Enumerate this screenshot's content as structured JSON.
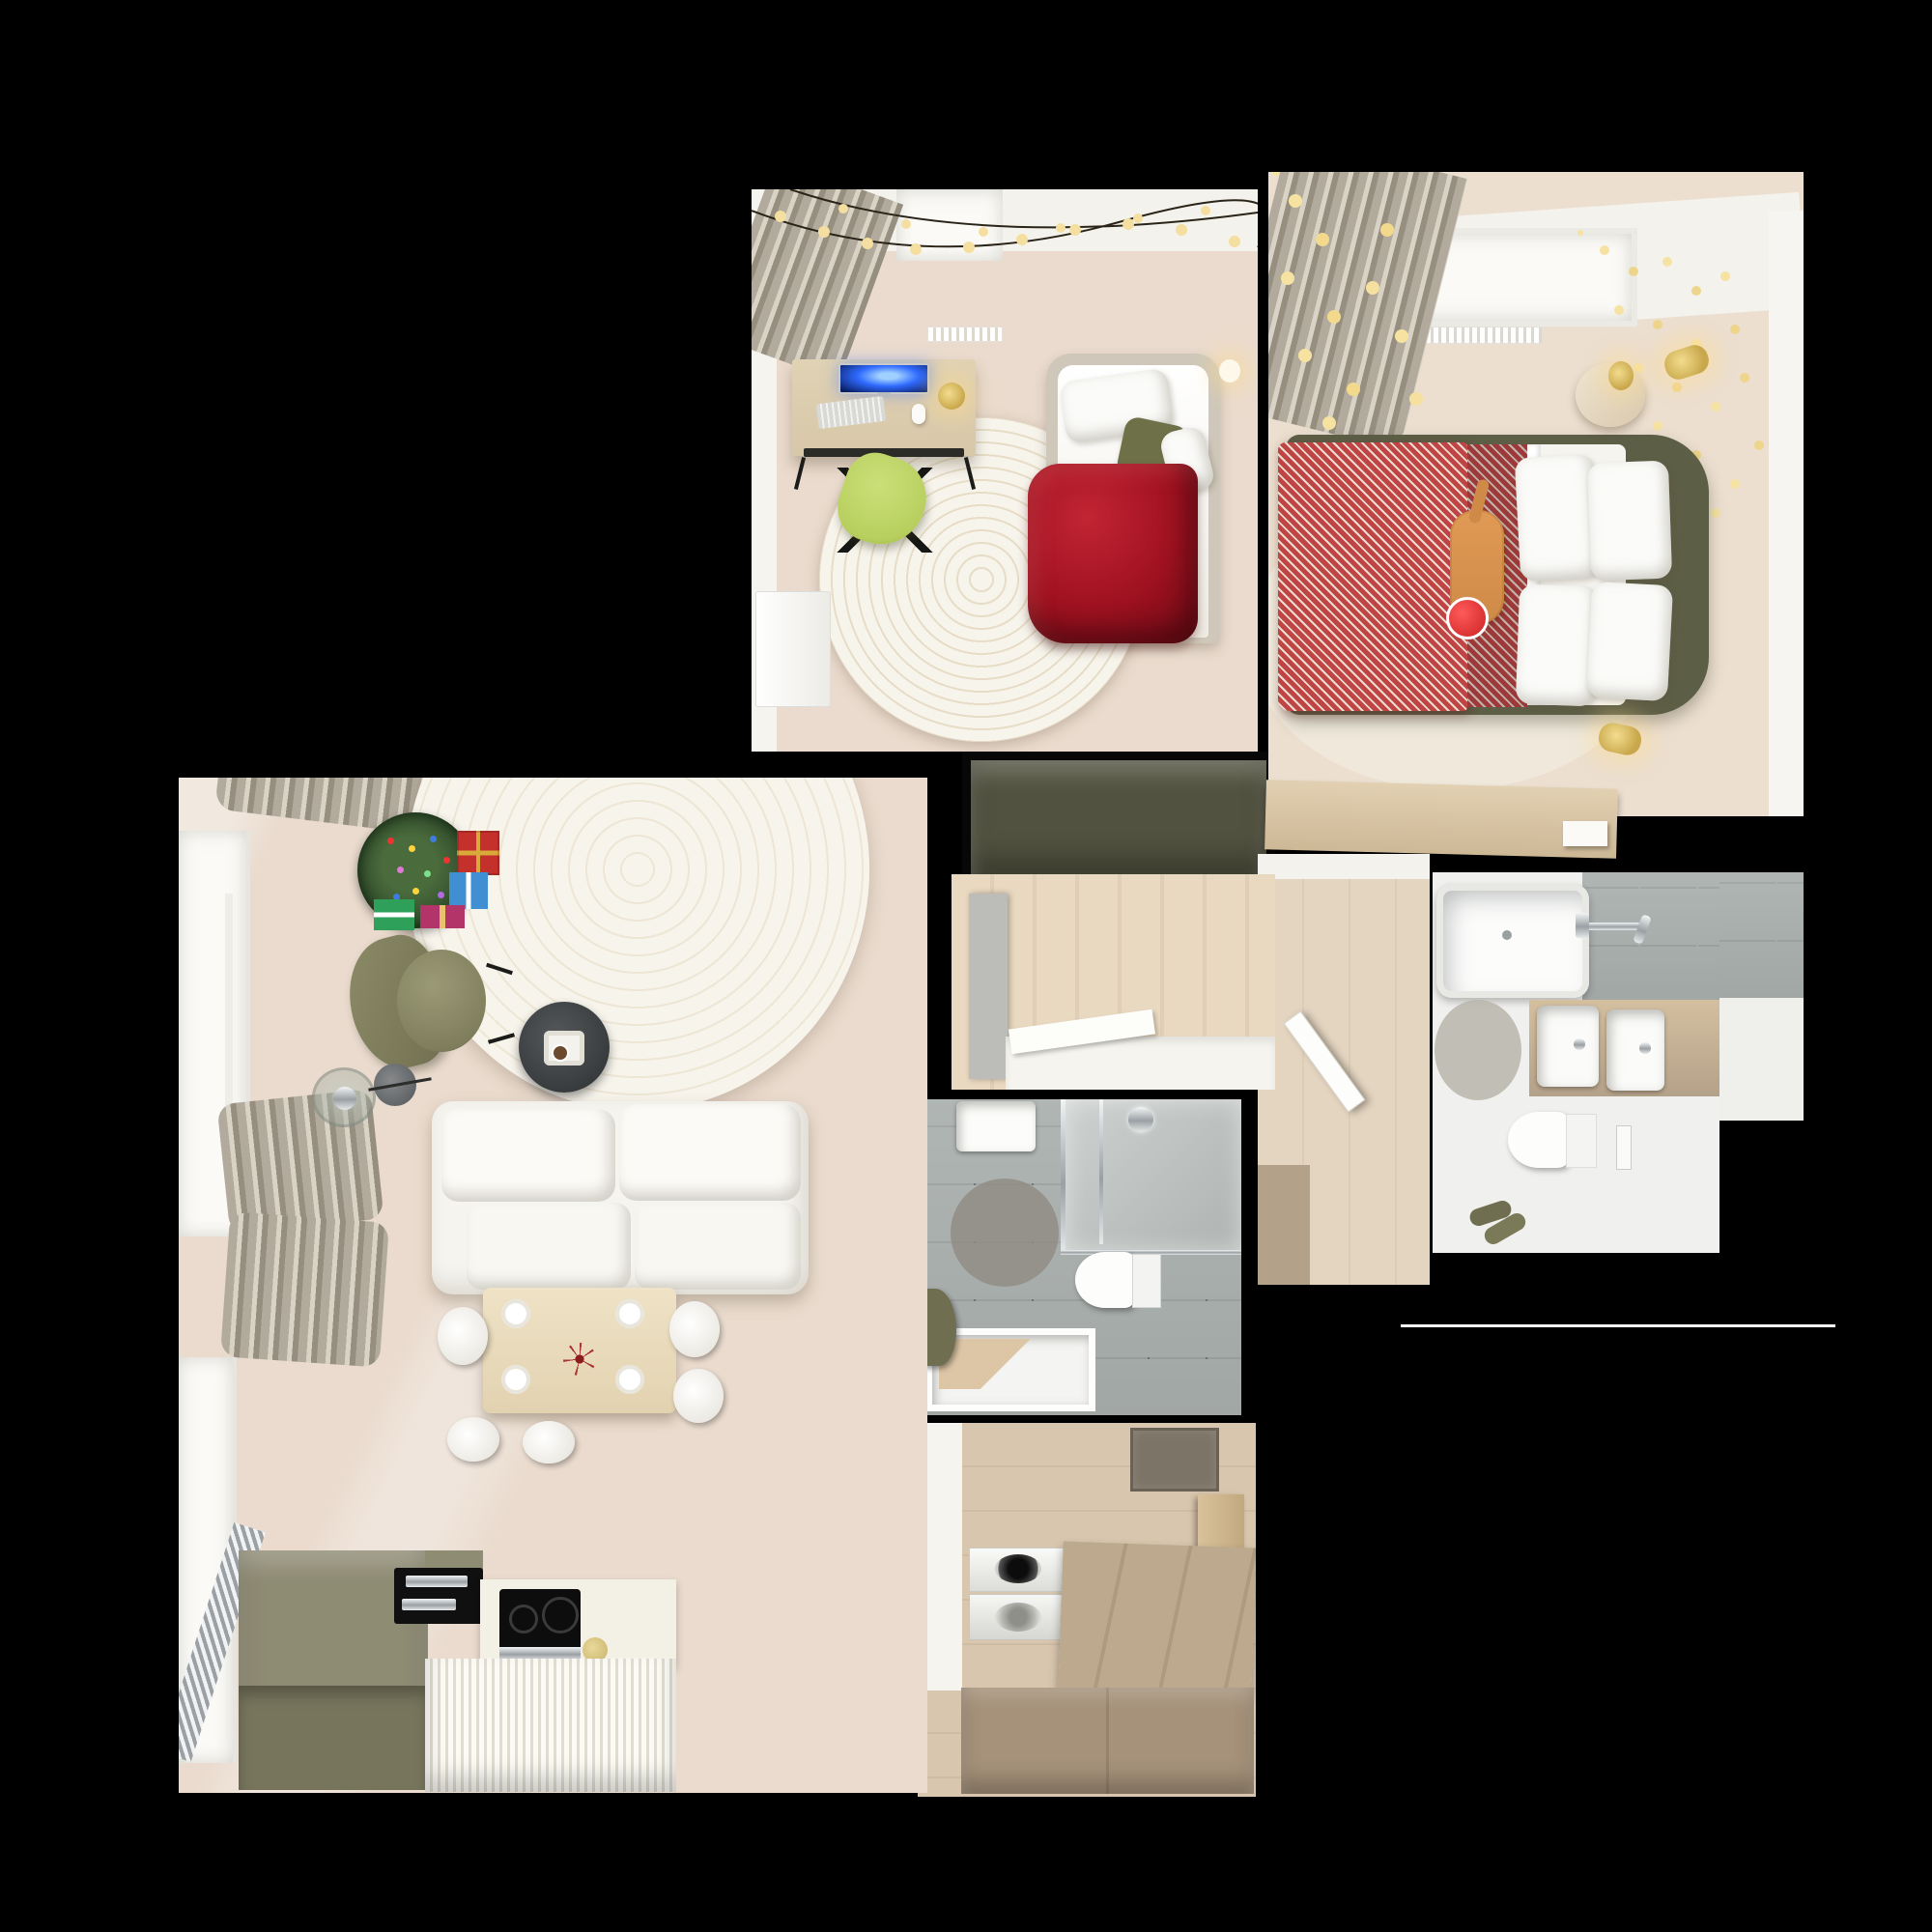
{
  "scene": {
    "title": "apartment-top-down-render",
    "description": "Overhead 3D render of an apartment floor plan on a black background, decorated for Christmas",
    "background_color": "#000000"
  },
  "palette": {
    "wallWhite": "#f4f2ed",
    "windowWhite": "#fbfaf7",
    "curtainGray": "#b2ab9d",
    "floorLight": "#ecdfd0",
    "floorPink": "#eadbce",
    "floorWood": "#e4d5c0",
    "floorLaundry": "#d9c6ae",
    "oliveDark": "#51523f",
    "oliveHeadboard": "#5d5e46",
    "oliveChair": "#7f7e5c",
    "oliveKitchen": "#8f8c74",
    "greenChair": "#b7cf5e",
    "redDuvet": "#9e1120",
    "redChevron": "#bf4545",
    "treeGreen": "#35522f",
    "screenBlue": "#2f6bff",
    "tileGray": "#aab0ae",
    "tileLight": "#c6cac8",
    "rugWhite": "#f7f4ec",
    "rugGrayRound": "#8f8b82",
    "woodDesk": "#d8c7a9",
    "woodCounter": "#b4a189",
    "cabinetWood": "#a6927a",
    "chromeGray": "#cfd2d4",
    "gold": "#c9a84c",
    "catOrange": "#cf8a48",
    "santaRed": "#cc2222"
  },
  "rooms": [
    {
      "name": "bedroom-office",
      "items": [
        "string-lights",
        "gray-curtain",
        "desk",
        "monitor",
        "keyboard",
        "mouse",
        "candle-lamp",
        "green-office-chair",
        "round-white-rug",
        "single-bed",
        "red-duvet",
        "pillows",
        "wall-lamp",
        "white-dresser",
        "radiator",
        "window"
      ]
    },
    {
      "name": "master-bedroom",
      "items": [
        "fairy-light-curtain",
        "branch-lights",
        "window",
        "radiator",
        "double-bed",
        "olive-headboard",
        "red-chevron-blanket",
        "white-pillows",
        "cat-with-santa-hat",
        "bedside-table",
        "gold-wall-lamps",
        "light-rug",
        "wardrobe-counter"
      ]
    },
    {
      "name": "living-kitchen",
      "items": [
        "christmas-tree",
        "gift-boxes",
        "white-round-rug",
        "olive-armchair",
        "floor-lamp",
        "glass-side-table",
        "charcoal-coffee-table",
        "white-sofa",
        "dining-table",
        "dining-chairs",
        "place-settings",
        "olive-kitchen-island",
        "black-sink",
        "induction-hob",
        "white-counter",
        "ribbed-cabinets",
        "windows",
        "gray-curtains",
        "chrome-rail",
        "radiator"
      ]
    },
    {
      "name": "hallway",
      "items": [
        "wood-floor",
        "open-door",
        "white-bench",
        "gray-pillar",
        "wood-counter"
      ]
    },
    {
      "name": "family-bathroom",
      "items": [
        "bathtub",
        "shower-mixer",
        "tiled-wall",
        "double-sink-vanity",
        "wall-hung-toilet",
        "flush-panel",
        "round-gray-rug",
        "slippers"
      ]
    },
    {
      "name": "shower-room",
      "items": [
        "washbasin",
        "glass-shower",
        "shower-head",
        "wall-hung-toilet",
        "round-gray-rug",
        "shower-tray",
        "olive-towel"
      ]
    },
    {
      "name": "laundry-room",
      "items": [
        "washer",
        "dryer",
        "wood-counter",
        "doormat",
        "cabinet",
        "shelf"
      ]
    }
  ],
  "notes": {
    "wardrobe_block": "dark olive built-in wardrobe between bedroom-office and hallway",
    "thin_white_line": "faint horizontal seam line right of the lower bathroom"
  }
}
